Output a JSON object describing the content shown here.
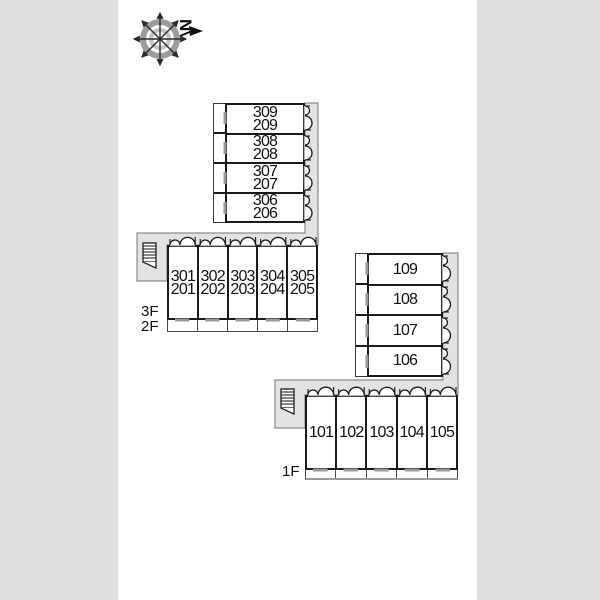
{
  "compass": {
    "north_label": "N"
  },
  "colors": {
    "background": "#dedede",
    "canvas": "#ffffff",
    "wall": "#1a1a1a",
    "corridor_fill": "#e2e2e2",
    "corridor_outline": "#8c8c8c",
    "window": "#999999",
    "opening": "#b3b3b3",
    "text": "#111111"
  },
  "plan": {
    "upper_wing": {
      "stack_rooms": [
        "309\n209",
        "308\n208",
        "307\n207",
        "306\n206"
      ],
      "row_rooms": [
        "301\n201",
        "302\n202",
        "303\n203",
        "304\n204",
        "305\n205"
      ],
      "floor_labels": [
        "3F",
        "2F"
      ]
    },
    "lower_wing": {
      "stack_rooms": [
        "109",
        "108",
        "107",
        "106"
      ],
      "row_rooms": [
        "101",
        "102",
        "103",
        "104",
        "105"
      ],
      "floor_labels": [
        "1F"
      ]
    }
  }
}
